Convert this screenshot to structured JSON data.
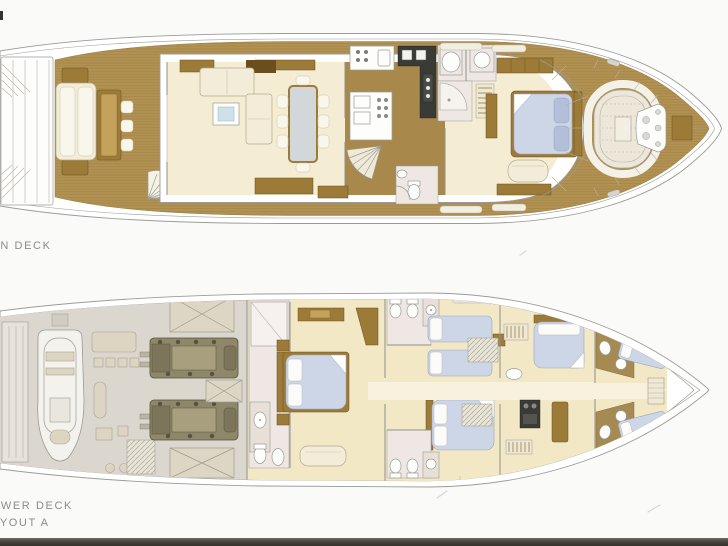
{
  "page": {
    "background": "#fafaf9",
    "scan_edge_color": "#45433d"
  },
  "labels": {
    "main_deck": "MAIN DECK",
    "lower_deck": "LOWER DECK",
    "layout": "LAYOUT A"
  },
  "colors": {
    "teak": "#b29252",
    "teak_line": "#9a7c3f",
    "wood": "#9c7a38",
    "wood_dark": "#6b4e1e",
    "wood_floor": "#a8894b",
    "cream": "#f4edd3",
    "cream_lower": "#f2e8c6",
    "corridor": "#f7f1de",
    "bed_blue": "#ccd6e6",
    "bed_blue_dark": "#b3bfd8",
    "bath_pink": "#efe7e3",
    "machinery": "#dbd7ce",
    "engine": "#8f8769",
    "engine_dark": "#57523f",
    "tank": "#ddd6c4",
    "appliance": "#3a3a36",
    "glass": "#cfe0e8",
    "line_gray": "#9b9b97",
    "label_gray": "#8b8b89"
  }
}
